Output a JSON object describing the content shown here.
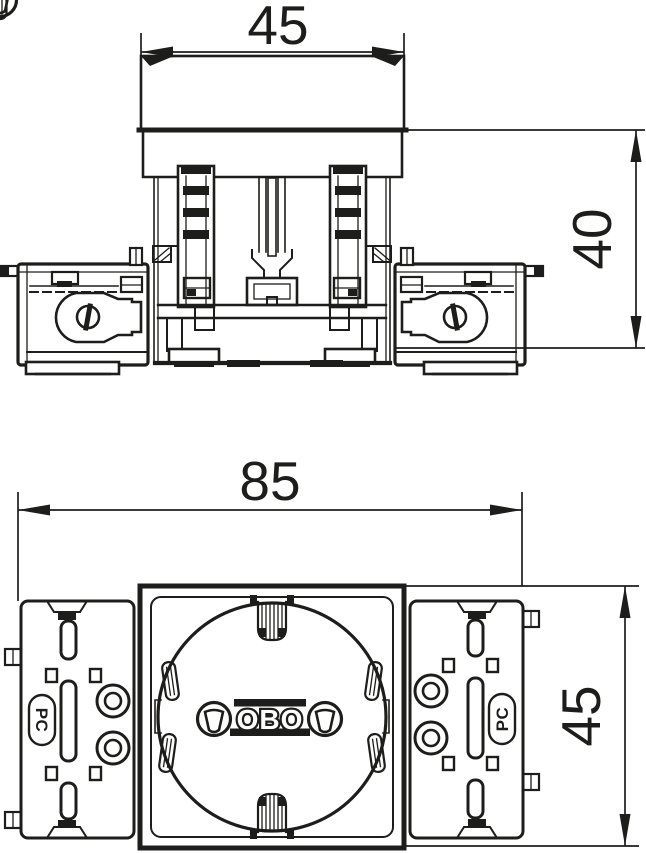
{
  "page": {
    "background": "#ffffff"
  },
  "drawing": {
    "line_color": "#1d1d1b",
    "dimensions": {
      "front_width": "45",
      "front_depth": "40",
      "plan_width": "85",
      "plan_height": "45"
    },
    "labels": {
      "brand_logo": "OBO",
      "module_left_marking": "PC",
      "module_right_marking": "PC"
    }
  }
}
